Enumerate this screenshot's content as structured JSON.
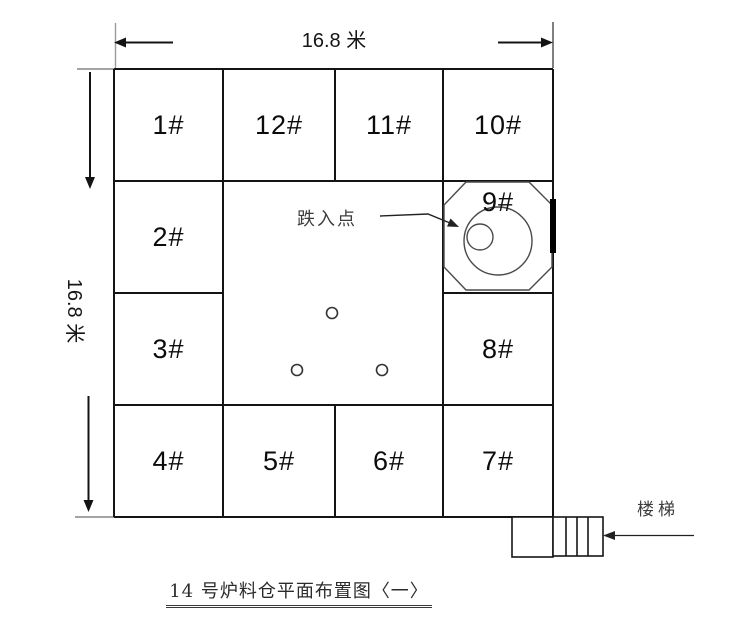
{
  "dimensions": {
    "top_label": "16.8 米",
    "left_label": "16.8 米"
  },
  "cells": {
    "c1": "1#",
    "c2": "2#",
    "c3": "3#",
    "c4": "4#",
    "c5": "5#",
    "c6": "6#",
    "c7": "7#",
    "c8": "8#",
    "c9": "9#",
    "c10": "10#",
    "c11": "11#",
    "c12": "12#"
  },
  "annotations": {
    "drop_point": "跌入点",
    "stairs": "楼梯"
  },
  "caption": "14 号炉料仓平面布置图〈一〉",
  "colors": {
    "grid_line": "#141414",
    "shape_line": "#4a4a4a",
    "extension_line": "#9a9a9a",
    "annotation_text": "#3d3d3d",
    "background": "#ffffff"
  }
}
